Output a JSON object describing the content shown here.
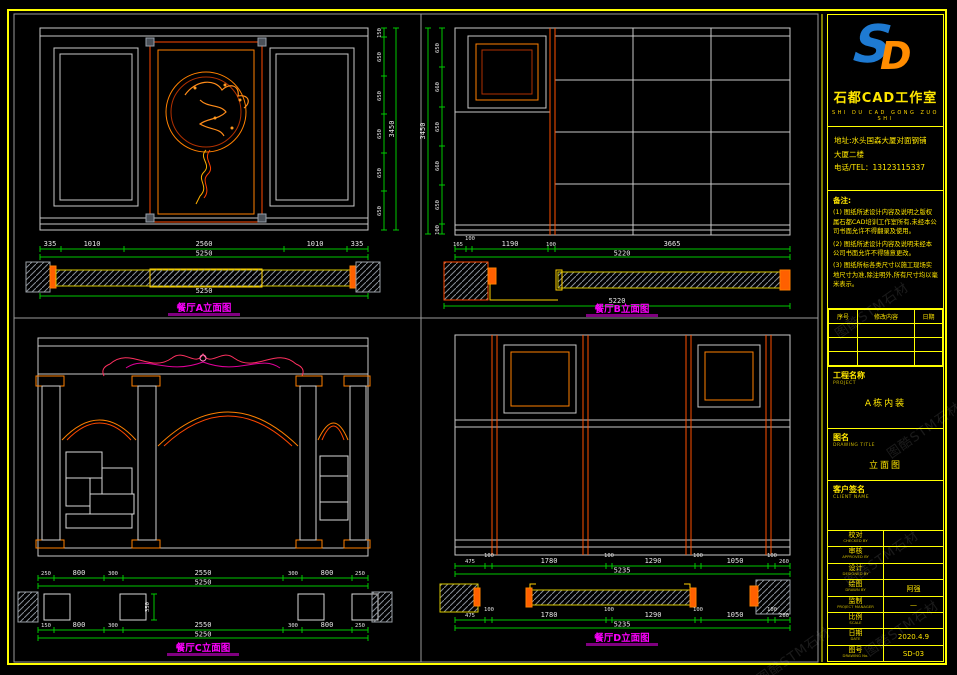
{
  "brand": {
    "logo_s": "S",
    "logo_d": "D",
    "name": "石都CAD工作室",
    "name_en": "SHI DU CAD GONG ZUO SHI"
  },
  "contact": {
    "line1": "地址:水头国森大厦对面钢铺",
    "line2": "大厦二楼",
    "line3": "电话/TEL：13123115337"
  },
  "notes": {
    "title": "备注:",
    "n1": "(1) 图纸所述设计内容及说明之版权属石都CAD培训工作室所有,未经本公司书面允许不得翻录及使用。",
    "n2": "(2) 图纸所述设计内容及说明未经本公司书面允许不得随意更改。",
    "n3": "(3) 图纸所标各类尺寸以施工现场实地尺寸为准,除注明外,所有尺寸均以毫米表示。"
  },
  "revisions": {
    "col1": "序号",
    "col2": "修改内容",
    "col3": "日期"
  },
  "fields": {
    "project_label": "工程名称",
    "project_en": "PROJECT",
    "project_value": "A栋内装",
    "title_label": "图名",
    "title_en": "DRAWING TITLE",
    "title_value": "立面图",
    "client_label": "客户签名",
    "client_en": "CLIENT NAME",
    "rows": [
      {
        "cn": "校对",
        "en": "CHECKED BY",
        "value": ""
      },
      {
        "cn": "审核",
        "en": "APPROVED BY",
        "value": ""
      },
      {
        "cn": "设计",
        "en": "DESIGNED BY",
        "value": ""
      },
      {
        "cn": "绘图",
        "en": "DRAWN BY",
        "value": "阿强"
      },
      {
        "cn": "监制",
        "en": "PROJECT MANAGER",
        "value": "—"
      },
      {
        "cn": "比例",
        "en": "SCALE",
        "value": ""
      },
      {
        "cn": "日期",
        "en": "DATE",
        "value": "2020.4.9"
      },
      {
        "cn": "图号",
        "en": "DRAWING No.",
        "value": "SD-03"
      }
    ]
  },
  "drawings": {
    "a": {
      "label": "餐厅A立面图",
      "dims_bottom": [
        "335",
        "1010",
        "2560",
        "1010",
        "335"
      ],
      "total_bottom": "5250",
      "plan_total": "5250",
      "dims_right": [
        "150",
        "650",
        "650",
        "650",
        "650",
        "650"
      ],
      "total_right": "3450"
    },
    "b": {
      "label": "餐厅B立面图",
      "dims_bottom": [
        "165",
        "100",
        "1190",
        "100",
        "3665"
      ],
      "total_bottom": "5220",
      "plan_total": "5220",
      "dims_left": [
        "650",
        "660",
        "650",
        "660",
        "650",
        "100"
      ],
      "total_left": "3450"
    },
    "c": {
      "label": "餐厅C立面图",
      "dims_row1": [
        "250",
        "800",
        "300",
        "2550",
        "300",
        "800",
        "250"
      ],
      "total1": "5250",
      "dims_row2": [
        "150",
        "800",
        "300",
        "2550",
        "300",
        "800",
        "250"
      ],
      "total2": "5250",
      "col_depth": "350"
    },
    "d": {
      "label": "餐厅D立面图",
      "dims_row1": [
        "475",
        "100",
        "1780",
        "100",
        "1290",
        "100",
        "1050",
        "100",
        "260"
      ],
      "total1": "5235",
      "dims_row2": [
        "475",
        "100",
        "1780",
        "100",
        "1290",
        "100",
        "1050",
        "100",
        "260"
      ],
      "total2": "5235"
    }
  },
  "watermark": {
    "text": "图酷STM石材"
  }
}
